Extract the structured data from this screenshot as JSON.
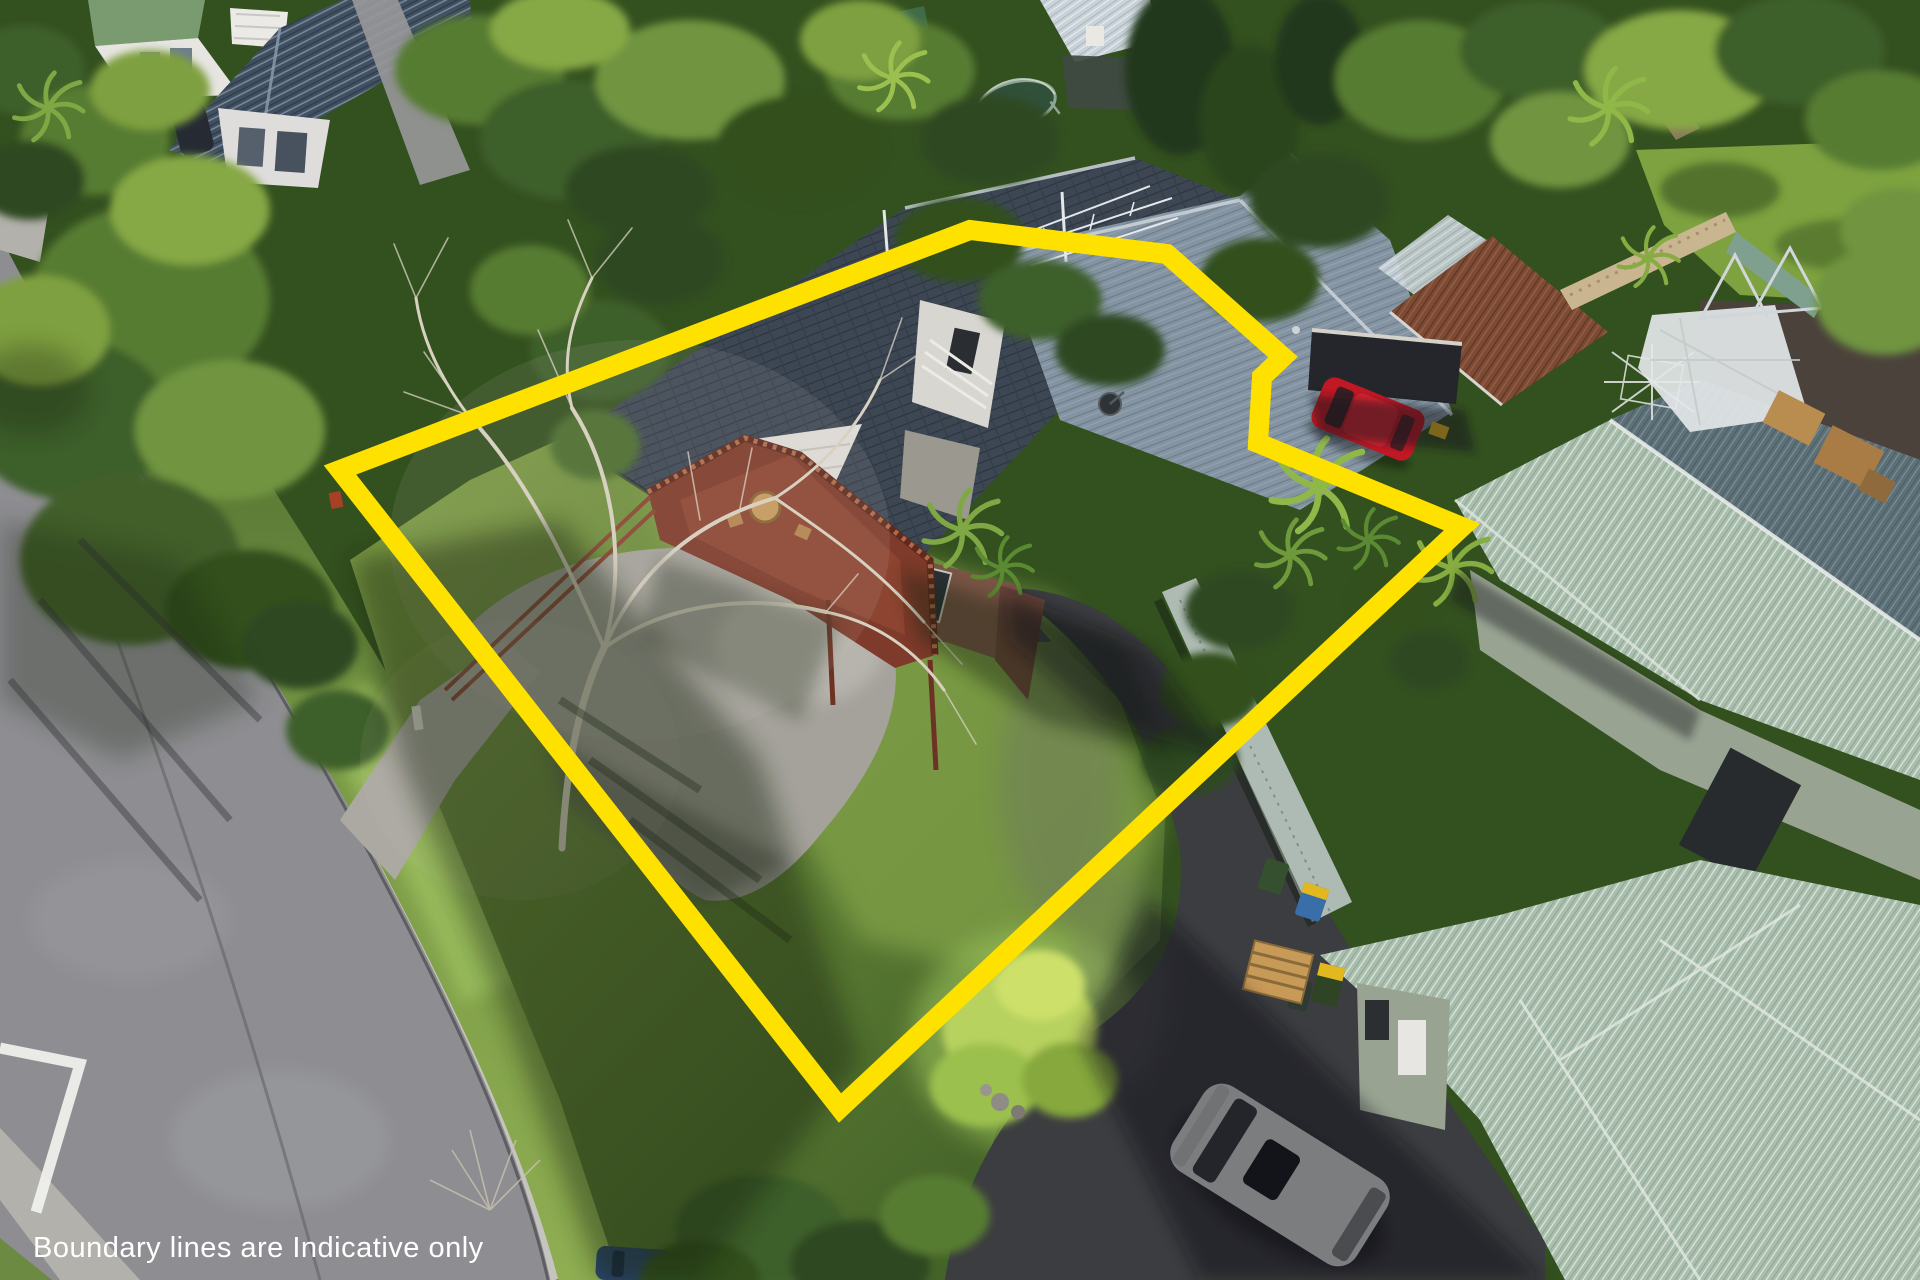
{
  "image_type": "aerial-drone-photograph",
  "caption": {
    "text": "Boundary lines are Indicative only",
    "color": "#ffffff",
    "font_size_px": 29,
    "x": 33,
    "y": 1257,
    "position": "bottom-left"
  },
  "boundary": {
    "label": "indicative-property-boundary",
    "color": "#FFE100",
    "stroke_width_px": 20,
    "style": "solid-closed-polygon",
    "points": [
      [
        340,
        470
      ],
      [
        970,
        230
      ],
      [
        1167,
        254
      ],
      [
        1283,
        357
      ],
      [
        1262,
        377
      ],
      [
        1258,
        443
      ],
      [
        1462,
        527
      ],
      [
        840,
        1108
      ]
    ]
  },
  "palette": {
    "road": "#8E8E92",
    "kerb": "#C6C4BF",
    "asphalt_dark": "#3C3D40",
    "asphalt_shaded": "#55565A",
    "concrete": "#A4A29B",
    "concrete_crossing": "#ABA9A2",
    "footpath": "#B3B1AC",
    "lawn_sun": "#8FAE52",
    "lawn_shade": "#3A5824",
    "rear_lawn": "#7DA23F",
    "dirt": "#4B433B",
    "roof_dark_grey": "#3D4754",
    "roof_light_grey": "#8494A2",
    "roof_teal": "#A9BEAD",
    "roof_teal_shade": "#5D7078",
    "roof_brown": "#7D4B34",
    "roof_navy": "#415061",
    "roof_green": "#7A9A70",
    "wall_white": "#DFDDD8",
    "wall_brick": "#7A5546",
    "wall_sage": "#98A391",
    "deck_rust": "#7E3A2A",
    "deck_rail": "#8A4431",
    "fence_grey": "#AEBBB4",
    "fence_tan": "#C9B690",
    "car_red": "#C01824",
    "car_white": "#D9DAD6",
    "car_blue": "#2B4668",
    "car_dark": "#262B33",
    "bin_yellow_lid": "#E3B81E",
    "bin_blue": "#3A6EA8",
    "bin_green": "#35502F",
    "pallet_wood": "#C89A58",
    "dead_tree": "#D8D1C2",
    "marking_white": "#F2F2EF"
  },
  "scene": {
    "description": "Aerial view of a suburban property outlined in yellow: grey-tiled house with rust-red timber deck, concrete driveway and large front lawn, street with kerb and white chevron marking at left, neighbouring houses with navy, brown and teal corrugated roofs, parked red, white and blue cars, trees including a large leafless deciduous tree over the lawn.",
    "objects": [
      "street",
      "kerb",
      "grass-berm",
      "white-road-chevron",
      "footpath",
      "neighbor-house-top-left",
      "rear-neighbor-house",
      "subject-house",
      "gable-wall",
      "timber-deck",
      "deck-table",
      "concrete-driveway",
      "shared-asphalt-driveway",
      "garage-brown-roof",
      "garage-door",
      "right-house-teal-roof-upper",
      "right-house-teal-roof-lower",
      "right-house-wall",
      "red-car",
      "white-car",
      "blue-car",
      "dark-car",
      "wheelie-bins",
      "wooden-pallet",
      "rotary-clothesline",
      "trampoline",
      "plastic-sheet",
      "garden-furniture",
      "tv-antenna",
      "satellite-dish",
      "chimney",
      "boundary-fence",
      "rear-fence",
      "letterboxes",
      "large-leafless-tree",
      "leafy-trees",
      "cabbage-tree-palms",
      "lime-green-tree",
      "lawn-shadows"
    ]
  }
}
